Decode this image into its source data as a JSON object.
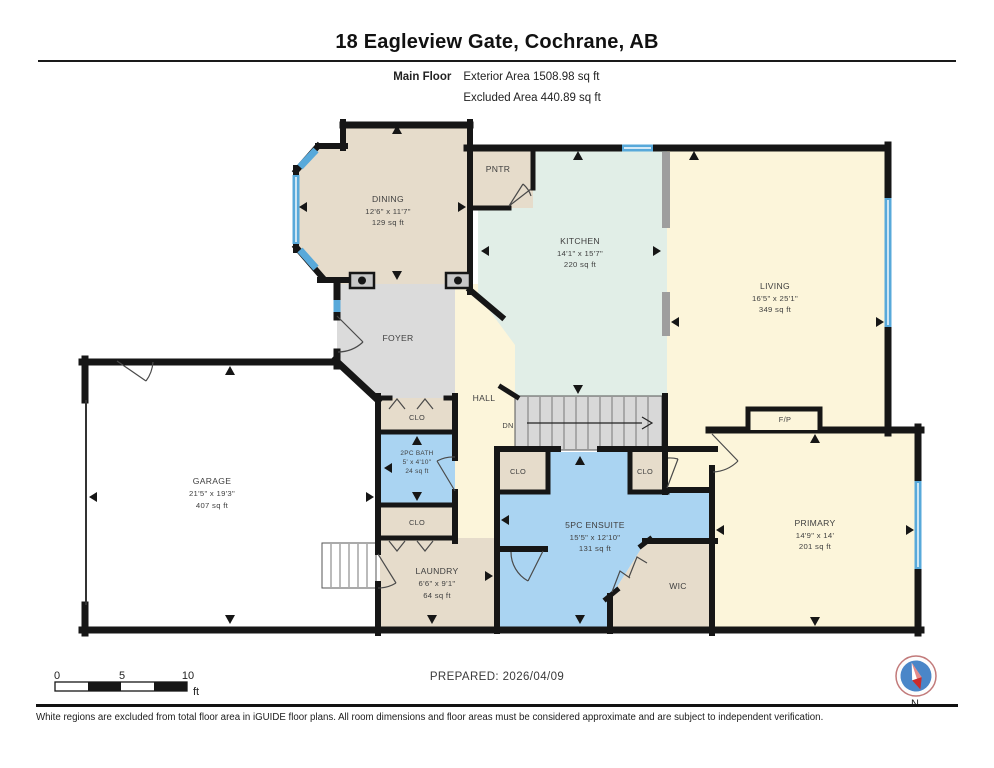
{
  "header": {
    "title": "18 Eagleview Gate, Cochrane, AB",
    "floor_label": "Main Floor",
    "area_line1": "Exterior Area 1508.98 sq ft",
    "area_line2": "Excluded Area 440.89 sq ft"
  },
  "rooms": {
    "dining": {
      "name": "DINING",
      "dims": "12'6\" x 11'7\"",
      "area": "129 sq ft"
    },
    "pantry": {
      "name": "PNTR"
    },
    "kitchen": {
      "name": "KITCHEN",
      "dims": "14'1\" x 15'7\"",
      "area": "220 sq ft"
    },
    "living": {
      "name": "LIVING",
      "dims": "16'5\" x 25'1\"",
      "area": "349 sq ft"
    },
    "foyer": {
      "name": "FOYER"
    },
    "hall": {
      "name": "HALL"
    },
    "stairs": {
      "label": "DN"
    },
    "closet_foyer": {
      "name": "CLO"
    },
    "bath": {
      "name": "2PC BATH",
      "dims": "5' x 4'10\"",
      "area": "24 sq ft"
    },
    "closet_hall": {
      "name": "CLO"
    },
    "laundry": {
      "name": "LAUNDRY",
      "dims": "6'6\" x 9'1\"",
      "area": "64 sq ft"
    },
    "garage": {
      "name": "GARAGE",
      "dims": "21'5\" x 19'3\"",
      "area": "407 sq ft"
    },
    "ensuite": {
      "name": "5PC ENSUITE",
      "dims": "15'5\" x 12'10\"",
      "area": "131 sq ft"
    },
    "closet_ensuite_left": {
      "name": "CLO"
    },
    "closet_ensuite_right": {
      "name": "CLO"
    },
    "wic": {
      "name": "WIC"
    },
    "primary": {
      "name": "PRIMARY",
      "dims": "14'9\" x 14'",
      "area": "201 sq ft"
    },
    "fireplace": {
      "name": "F/P"
    }
  },
  "footer": {
    "prepared": "PREPARED: 2026/04/09",
    "disclaimer": "White regions are excluded from total floor area in iGUIDE floor plans. All room dimensions and floor areas must be considered approximate and are subject to independent verification.",
    "compass_label": "N",
    "scale": {
      "t0": "0",
      "t5": "5",
      "t10": "10",
      "unit": "ft"
    }
  },
  "colors": {
    "room_beige": "#e6dccb",
    "room_mint": "#e1eee7",
    "room_yellow": "#fcf5da",
    "room_blue": "#aad4f2",
    "room_gray": "#dbdbdb",
    "wall": "#161616",
    "window": "#58a9da",
    "half_wall": "#9e9e9e"
  }
}
